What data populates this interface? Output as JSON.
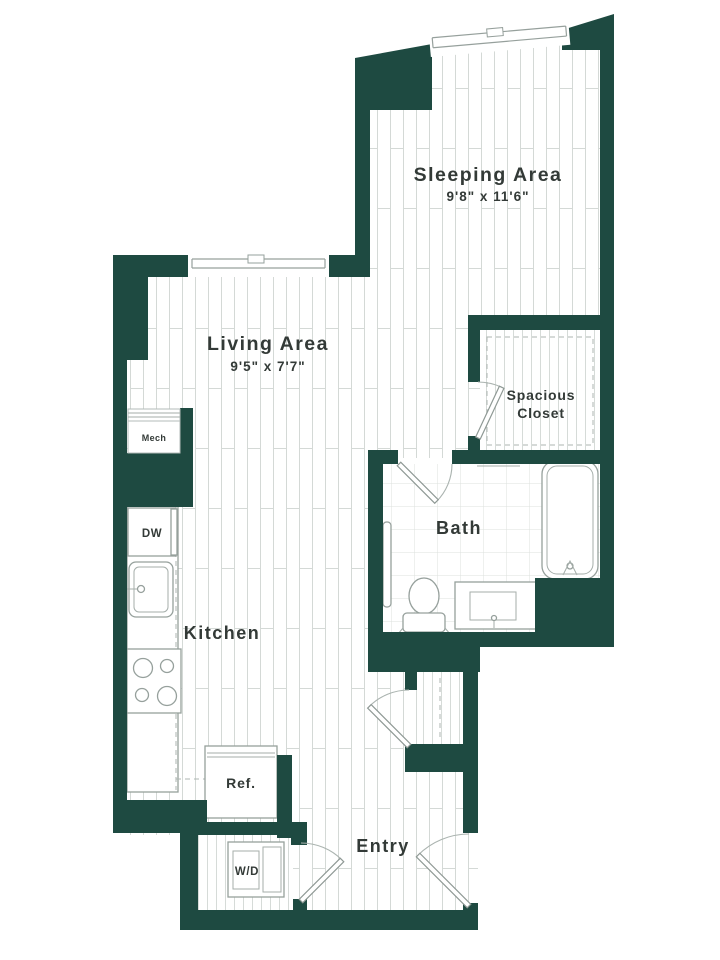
{
  "title": "Studio apartment floor plan",
  "colors": {
    "wall": "#1e4a41",
    "floor_line": "#d4d9d6",
    "tile_line": "#dce0de",
    "fixture_stroke": "#96a09c",
    "label_text": "#333a37",
    "background": "#ffffff"
  },
  "rooms": {
    "sleeping": {
      "label": "Sleeping Area",
      "dimensions": "9'8\" x 11'6\""
    },
    "living": {
      "label": "Living Area",
      "dimensions": "9'5\" x 7'7\""
    },
    "kitchen": {
      "label": "Kitchen"
    },
    "bath": {
      "label": "Bath"
    },
    "closet": {
      "label_line1": "Spacious",
      "label_line2": "Closet"
    },
    "entry": {
      "label": "Entry"
    },
    "mech": {
      "label": "Mech"
    }
  },
  "appliances": {
    "dishwasher": "DW",
    "refrigerator": "Ref.",
    "washer_dryer": "W/D"
  }
}
